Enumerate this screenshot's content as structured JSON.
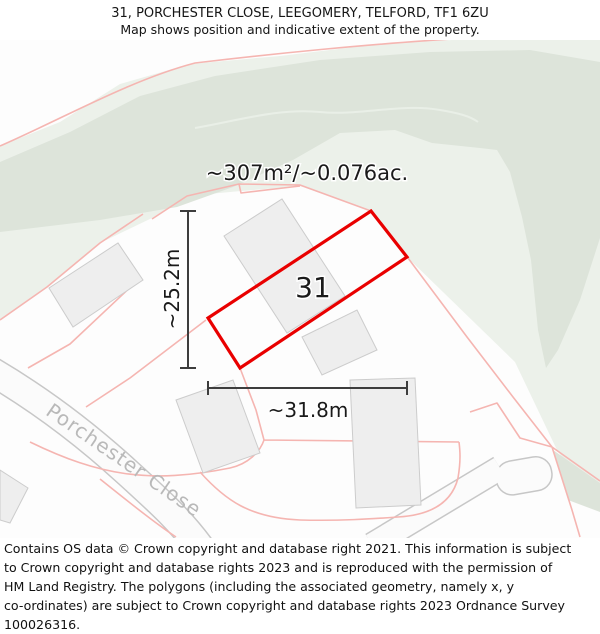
{
  "header": {
    "title": "31, PORCHESTER CLOSE, LEEGOMERY, TELFORD, TF1 6ZU",
    "subtitle": "Map shows position and indicative extent of the property."
  },
  "map": {
    "area_label": "~307m²/~0.076ac.",
    "plot_number": "31",
    "width_label": "~31.8m",
    "height_label": "~25.2m",
    "street_label": "Porchester Close",
    "colors": {
      "plot_outline": "#e90000",
      "boundary_pink": "#f5b5b1",
      "green_light": "#ecf1ea",
      "green_dark": "#dde4da",
      "building_fill": "#eeeeee",
      "building_stroke": "#cccccc",
      "road_casing": "#c7c7c7",
      "road_fill": "#fbfbfb",
      "dimension_line": "#3d3d3d",
      "street_text": "#b9b9b9",
      "map_background": "#fdfdfd"
    }
  },
  "footer": {
    "lines": [
      "Contains OS data © Crown copyright and database right 2021. This information is subject",
      "to Crown copyright and database rights 2023 and is reproduced with the permission of",
      "HM Land Registry. The polygons (including the associated geometry, namely x, y",
      "co-ordinates) are subject to Crown copyright and database rights 2023 Ordnance Survey",
      "100026316."
    ]
  }
}
